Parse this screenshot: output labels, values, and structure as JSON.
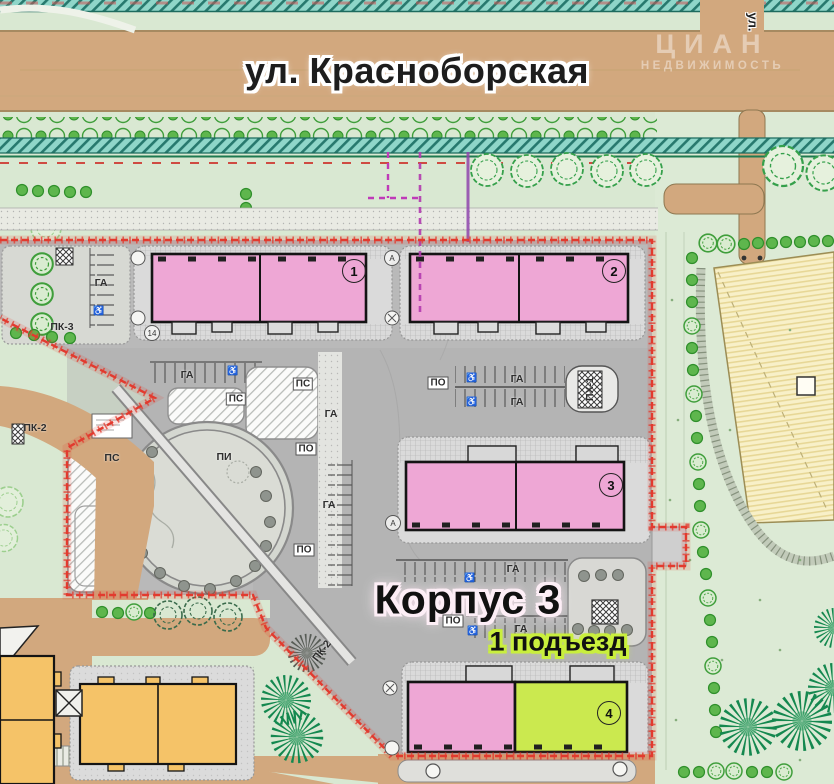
{
  "streets": {
    "main": "ул. Красноборская",
    "cross": "ул."
  },
  "watermark": {
    "brand": "ЦИАН",
    "subtitle": "НЕДВИЖИМОСТЬ"
  },
  "callouts": {
    "building": "Корпус 3",
    "entrance": "1 подъезд"
  },
  "buildings": [
    {
      "number": "1"
    },
    {
      "number": "2"
    },
    {
      "number": "3"
    },
    {
      "number": "4"
    }
  ],
  "zone_labels": {
    "ga": "ГА",
    "ps": "ПС",
    "po": "ПО",
    "pi": "ПИ",
    "ph1": "ПХ-1",
    "pk2": "ПК-2",
    "pk3": "ПК-3"
  },
  "axis_markers": {
    "a": "А",
    "n14": "14"
  },
  "symbols": {
    "disabled_parking": "♿"
  },
  "colors": {
    "site_boundary_red": "#e23a2e",
    "building_pink": "#eea7d5",
    "entrance_highlight_lime": "#cbe94f",
    "existing_building_yellow": "#f5c368",
    "road_tan": "#d2a87e",
    "greenery_light": "#d9e8d2",
    "cycle_strip_teal": "#8fd6c9",
    "tree_green": "#5eb64d",
    "utility_line_magenta": "#bf3ab8"
  }
}
